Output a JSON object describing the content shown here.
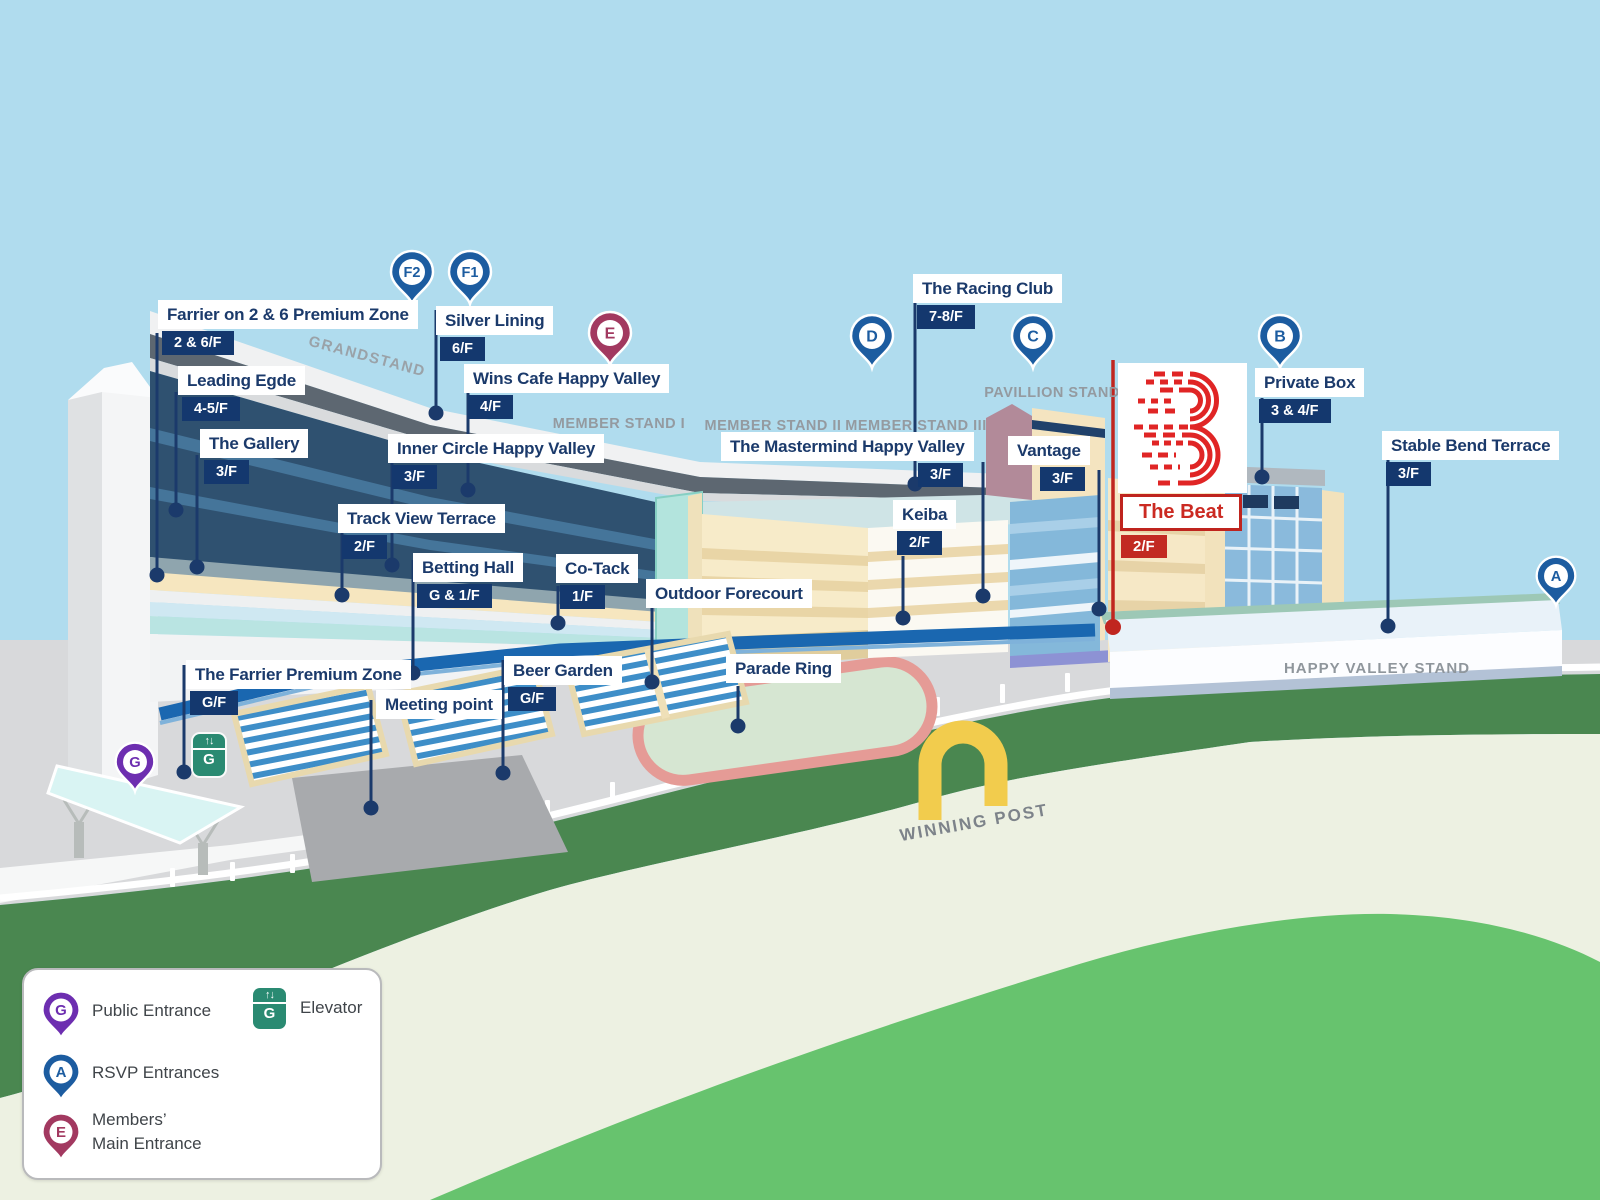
{
  "map": {
    "stands": {
      "grandstand": "GRANDSTAND",
      "member_stand_1": "MEMBER STAND I",
      "member_stand_2": "MEMBER STAND II",
      "member_stand_3": "MEMBER STAND III",
      "pavillion_stand": "PAVILLION STAND",
      "happy_valley_stand": "HAPPY VALLEY STAND",
      "winning_post": "WINNING POST"
    },
    "venues": [
      {
        "name": "Farrier on 2 & 6 Premium Zone",
        "floor": "2 & 6/F"
      },
      {
        "name": "Silver Lining",
        "floor": "6/F"
      },
      {
        "name": "Leading Egde",
        "floor": "4-5/F"
      },
      {
        "name": "Wins Cafe Happy Valley",
        "floor": "4/F"
      },
      {
        "name": "The Gallery",
        "floor": "3/F"
      },
      {
        "name": "Inner Circle Happy Valley",
        "floor": "3/F"
      },
      {
        "name": "Track View Terrace",
        "floor": "2/F"
      },
      {
        "name": "Betting Hall",
        "floor": "G & 1/F"
      },
      {
        "name": "Co-Tack",
        "floor": "1/F"
      },
      {
        "name": "Outdoor Forecourt"
      },
      {
        "name": "The Farrier Premium Zone",
        "floor": "G/F"
      },
      {
        "name": "Beer Garden",
        "floor": "G/F"
      },
      {
        "name": "Meeting point"
      },
      {
        "name": "Parade Ring"
      },
      {
        "name": "The Racing Club",
        "floor": "7-8/F"
      },
      {
        "name": "The Mastermind Happy Valley",
        "floor": "3/F"
      },
      {
        "name": "Keiba",
        "floor": "2/F"
      },
      {
        "name": "Vantage",
        "floor": "3/F"
      },
      {
        "name": "Private Box",
        "floor": "3 & 4/F"
      },
      {
        "name": "Stable Bend Terrace",
        "floor": "3/F"
      }
    ],
    "the_beat": {
      "name": "The Beat",
      "floor": "2/F"
    },
    "entrances": [
      {
        "id": "F2"
      },
      {
        "id": "F1"
      },
      {
        "id": "E"
      },
      {
        "id": "D"
      },
      {
        "id": "C"
      },
      {
        "id": "B"
      },
      {
        "id": "A"
      },
      {
        "id": "G"
      }
    ],
    "elevator_label": "G"
  },
  "legend": {
    "public_entrance": "Public Entrance",
    "rsvp_entrances": "RSVP Entrances",
    "members_main_entrance": "Members’\nMain Entrance",
    "elevator": "Elevator",
    "marker_public": "G",
    "marker_rsvp": "A",
    "marker_members": "E"
  },
  "colors": {
    "sky": "#b0dcee",
    "label_navy": "#1b3a6b",
    "badge_navy": "#14386e",
    "beat_red": "#c22a22",
    "pin_blue": "#1c5ca0",
    "pin_purple": "#6d2eb0",
    "pin_maroon": "#a23960",
    "elevator_green": "#2a8a72",
    "track_green": "#4a8750",
    "infield_green": "#edf1e2",
    "hill_green": "#67c36e"
  }
}
